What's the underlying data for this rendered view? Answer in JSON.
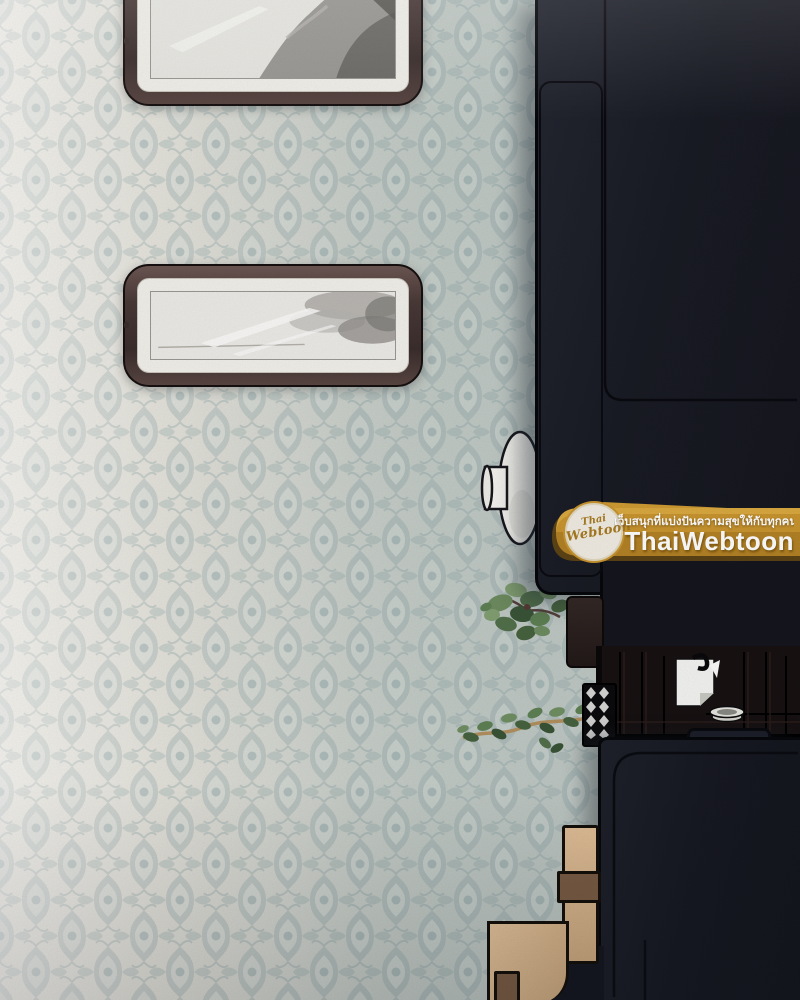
{
  "watermark": {
    "tagline_th": "เว็บสนุกที่แบ่งปันความสุขให้กับทุกคน",
    "brand": "ThaiWebtoon",
    "badge_line1": "Thai",
    "badge_line2": "Webtoon",
    "colors": {
      "banner_gold": "#c9952f",
      "banner_shadow": "#6e4f13",
      "badge_bg": "#f1ede3",
      "badge_text": "#a87b22",
      "text_white": "#ffffff"
    }
  },
  "palette": {
    "wallpaper_base_light": "#eae7de",
    "wallpaper_base_blue": "#c9cfc9",
    "wallpaper_pattern": "#8aa2a4",
    "sofa_dark_navy": "#1a1c25",
    "table_dark_brown": "#171112",
    "frame_wood_brown": "#4a3a38",
    "frame_mat_white": "#f3f1eb",
    "art_gray": "#8b8986",
    "vase_white": "#f6f5f0",
    "wood_light_tan": "#d9b78f",
    "wood_patch_brown": "#7b5d45",
    "plant_green": "#5f8054",
    "planter_black": "#0b0b0d"
  }
}
